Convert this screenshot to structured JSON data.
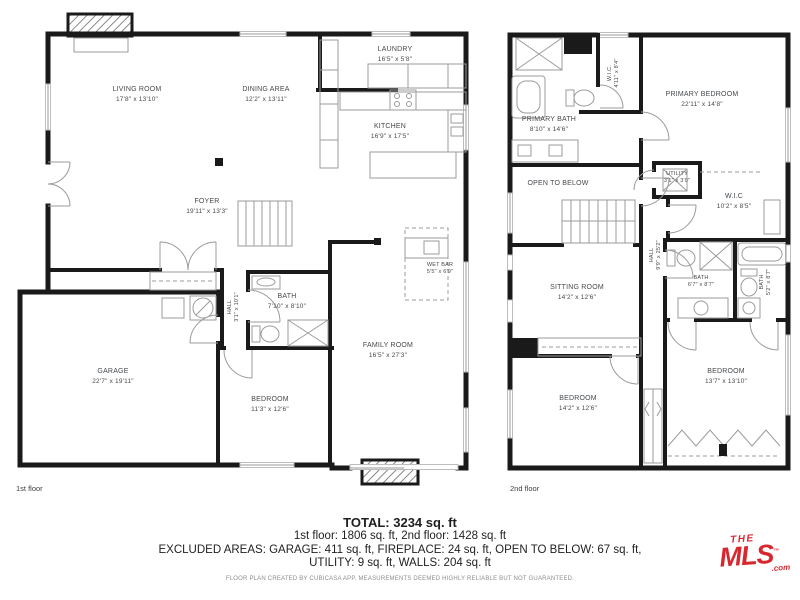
{
  "floors": {
    "first": {
      "caption": "1st floor",
      "rooms": {
        "living_room": {
          "name": "LIVING ROOM",
          "dims": "17'8\" x 13'10\""
        },
        "dining_area": {
          "name": "DINING AREA",
          "dims": "12'2\" x 13'11\""
        },
        "laundry": {
          "name": "LAUNDRY",
          "dims": "16'5\" x 5'8\""
        },
        "kitchen": {
          "name": "KITCHEN",
          "dims": "16'9\" x 17'5\""
        },
        "foyer": {
          "name": "FOYER",
          "dims": "19'11\" x 13'3\""
        },
        "hall": {
          "name": "HALL",
          "dims": "3'1\" x 10'1\""
        },
        "bath": {
          "name": "BATH",
          "dims": "7'10\" x 8'10\""
        },
        "garage": {
          "name": "GARAGE",
          "dims": "22'7\" x 19'11\""
        },
        "bedroom": {
          "name": "BEDROOM",
          "dims": "11'3\" x 12'6\""
        },
        "family_room": {
          "name": "FAMILY ROOM",
          "dims": "16'5\" x 27'3\""
        },
        "wet_bar": {
          "name": "WET BAR",
          "dims": "5'5\" x 6'9\""
        }
      }
    },
    "second": {
      "caption": "2nd floor",
      "rooms": {
        "primary_bedroom": {
          "name": "PRIMARY BEDROOM",
          "dims": "22'11\" x 14'8\""
        },
        "primary_bath": {
          "name": "PRIMARY BATH",
          "dims": "8'10\" x 14'6\""
        },
        "wic_small": {
          "name": "W.I.C.",
          "dims": "4'11\" x 8'4\""
        },
        "open_to_below": {
          "name": "OPEN TO BELOW"
        },
        "utility": {
          "name": "UTILITY",
          "dims": "3'1\" x 3'0\""
        },
        "wic": {
          "name": "W.I.C",
          "dims": "10'2\" x 8'5\""
        },
        "hall": {
          "name": "HALL",
          "dims": "9'9\" x 25'2\""
        },
        "sitting_room": {
          "name": "SITTING ROOM",
          "dims": "14'2\" x 12'6\""
        },
        "bath": {
          "name": "BATH",
          "dims": "6'7\" x 8'7\""
        },
        "bath_right": {
          "name": "BATH",
          "dims": "5'2\" x 8'7\""
        },
        "bedroom_left": {
          "name": "BEDROOM",
          "dims": "14'2\" x 12'6\""
        },
        "bedroom_right": {
          "name": "BEDROOM",
          "dims": "13'7\" x 13'10\""
        }
      }
    }
  },
  "summary": {
    "total": "TOTAL: 3234 sq. ft",
    "line1": "1st floor: 1806 sq. ft, 2nd floor: 1428 sq. ft",
    "line2": "EXCLUDED AREAS: GARAGE: 411 sq. ft, FIREPLACE: 24 sq. ft, OPEN TO BELOW: 67 sq. ft,",
    "line3": "UTILITY: 9 sq. ft, WALLS: 204 sq. ft",
    "disclaimer": "FLOOR PLAN CREATED BY CUBICASA APP. MEASUREMENTS DEEMED HIGHLY RELIABLE BUT NOT GUARANTEED."
  },
  "logo": {
    "the": "THE",
    "mls": "MLS",
    "tm": "™",
    "com": ".com",
    "color": "#d7282f"
  }
}
